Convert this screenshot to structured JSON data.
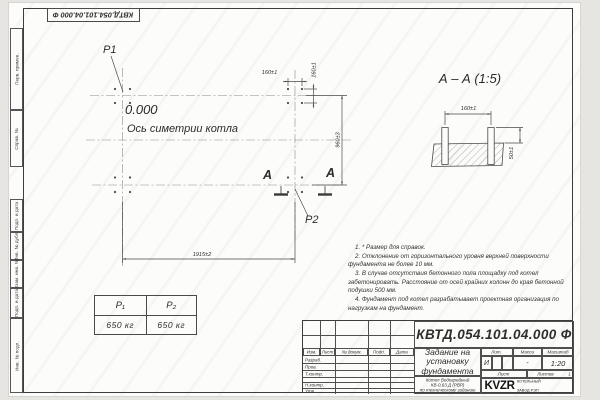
{
  "doc_number": "КВТД.054.101.04.000  Ф",
  "margin_labels": [
    "Перв. примен.",
    "Справ. №",
    "Подп. и дата",
    "Инв. № дубл.",
    "Взам. инв. №",
    "Подп. и дата",
    "Инв. № подл."
  ],
  "plan": {
    "point1": "P1",
    "point2": "P2",
    "elevation": "0.000",
    "axis_label": "Ось симетрии котла",
    "dim_bolt_spacing_h": "160±1",
    "dim_bolt_spacing_v": "160±1",
    "dim_row_spacing": "960±3",
    "dim_axis_spacing": "1915±2",
    "section_mark_left": "А",
    "section_mark_right": "А"
  },
  "section_view": {
    "title": "А – А (1:5)",
    "dim_bolt_spacing": "160±1",
    "dim_protrusion": "50±1"
  },
  "load_table": {
    "headers": [
      "Р₁",
      "Р₂"
    ],
    "values": [
      "650 кг",
      "650 кг"
    ]
  },
  "notes": [
    "1. * Размер для справок.",
    "2. Отклонение от горизонтального уровня верхней поверхности фундамента не более 10 мм.",
    "3. В случае отсутствия бетонного пола площадку под котел забетонировать. Расстояние от осей крайних колонн до края бетонной подушки 500 мм.",
    "4. Фундамент под котел разрабатывает проектная организация по нагрузкам на фундамент."
  ],
  "title_block": {
    "title_lines": [
      "Задание на",
      "установку",
      "фундамента"
    ],
    "product_lines": [
      "Котел Водогрейный",
      "КВ-0,63 Д (РВР)",
      "по техническому заданию"
    ],
    "header_cols": [
      "Изм.",
      "Лист",
      "№ докум.",
      "Подп.",
      "Дата"
    ],
    "row_labels": [
      "Разраб.",
      "Пров.",
      "Т.контр.",
      "Н.контр.",
      "Утв."
    ],
    "lit_label": "Лит.",
    "mass_label": "Масса",
    "scale_label": "Масштаб",
    "lit_value": "И",
    "mass_value": "-",
    "scale_value": "1:20",
    "sheet_label": "Лист",
    "sheets_label": "Листов",
    "sheets_value": "1",
    "logo_text": "KVZR",
    "logo_caption_lines": [
      "КОТЕЛЬНЫЙ",
      "ЗАВОД РЭП"
    ],
    "format_label": "Формат А3"
  }
}
